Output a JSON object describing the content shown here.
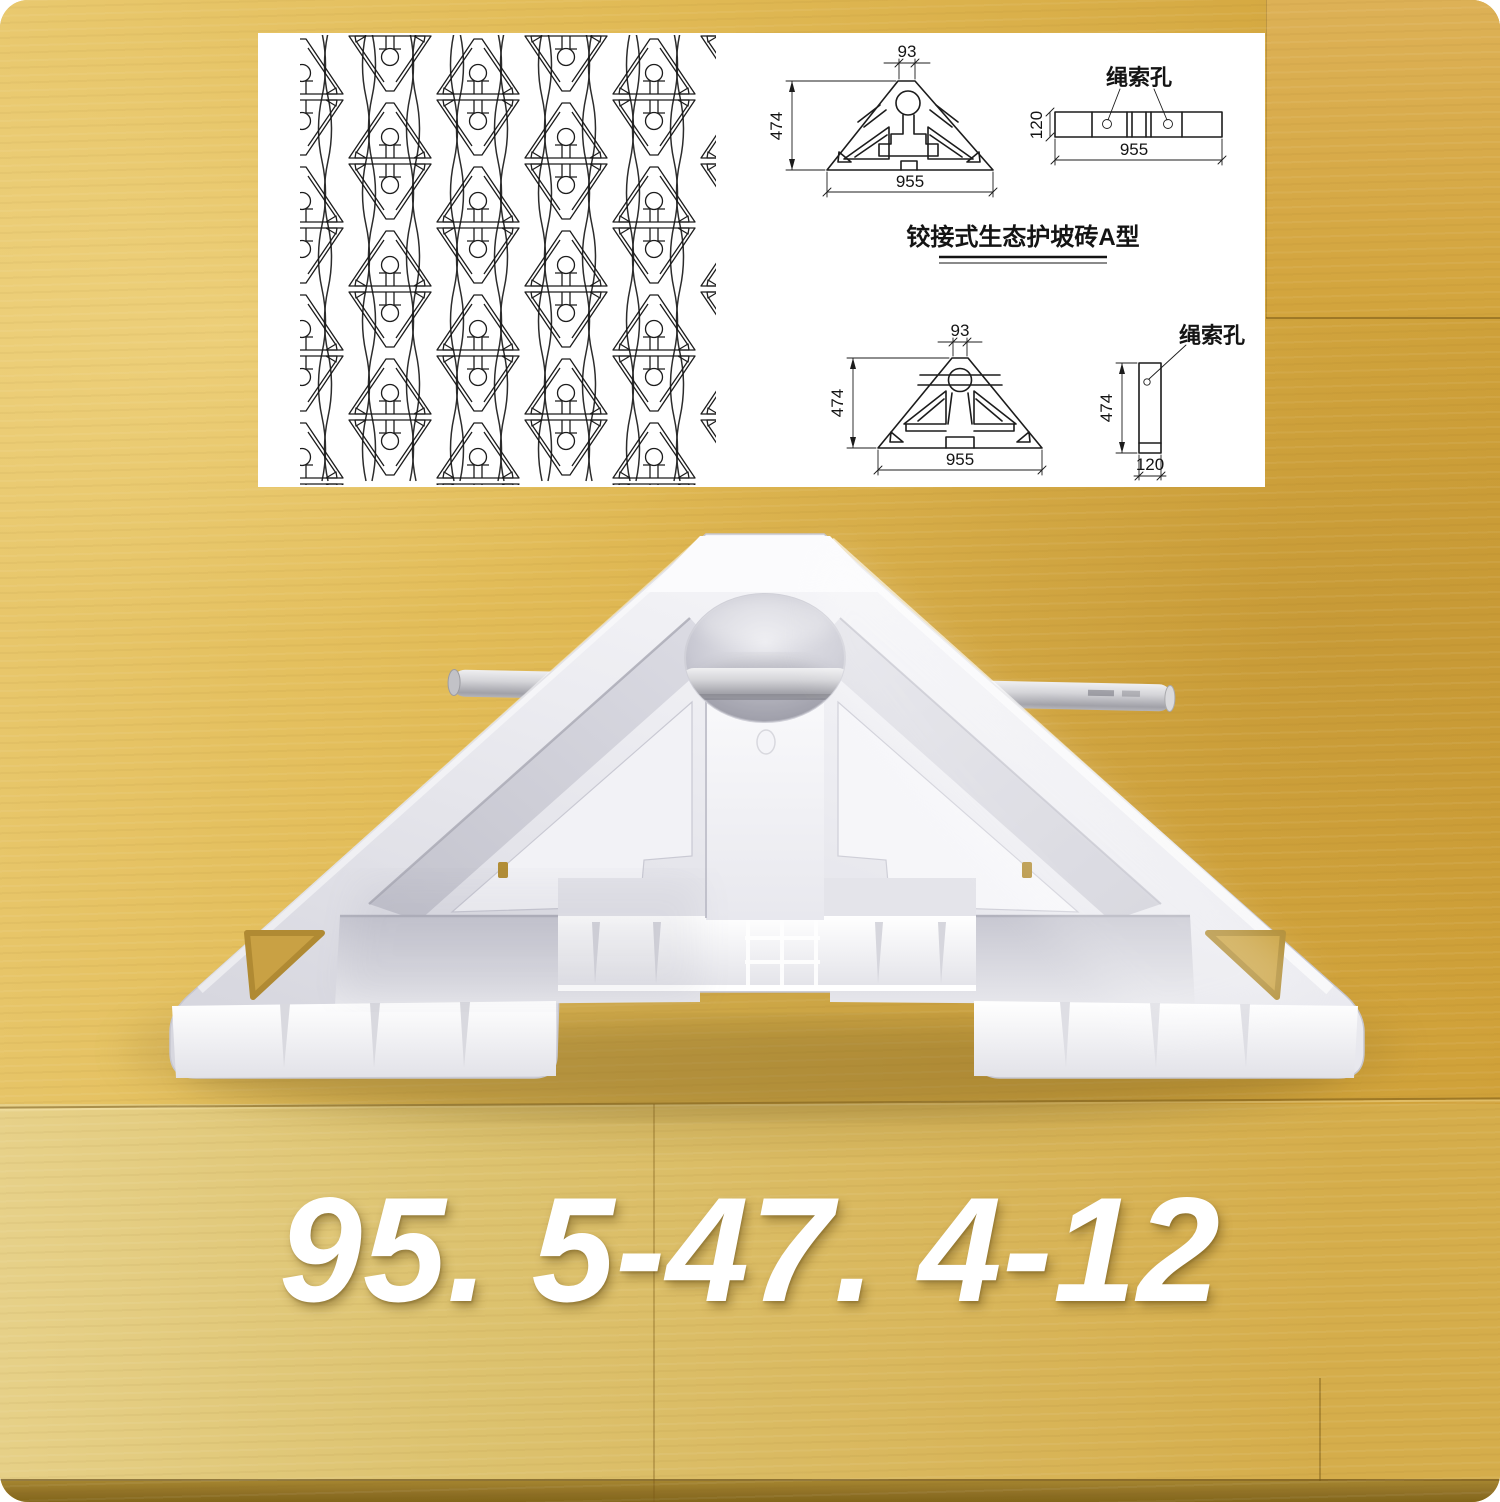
{
  "product_code": "95. 5-47. 4-12",
  "panel": {
    "title": "铰接式生态护坡砖A型",
    "rope_hole_label": "绳索孔",
    "dimensions": {
      "apex_width": "93",
      "height": "474",
      "base_width": "955",
      "thickness": "120"
    }
  },
  "colors": {
    "wood_base": "#d9b255",
    "wood_light": "#e7d189",
    "wood_dark": "#cfa038",
    "mold_plastic": "#f2f2f6",
    "drawing_line": "#1c1c1c",
    "code_text": "#ffffff"
  }
}
